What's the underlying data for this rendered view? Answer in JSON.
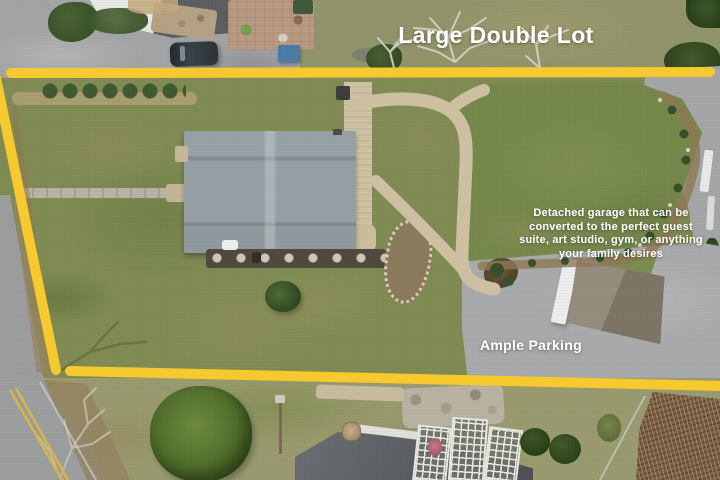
{
  "annotations": {
    "headline": "Large Double Lot",
    "garage_note_lines": [
      "Detached garage that can be",
      "converted to the perfect guest",
      "suite, art studio, gym, or anything",
      "your family desires"
    ],
    "parking_label": "Ample Parking"
  },
  "colors": {
    "boundary-yellow": "#F6C92F",
    "annotation-text": "#FFFFFF",
    "road-marking-yellow": "#D8B544"
  }
}
